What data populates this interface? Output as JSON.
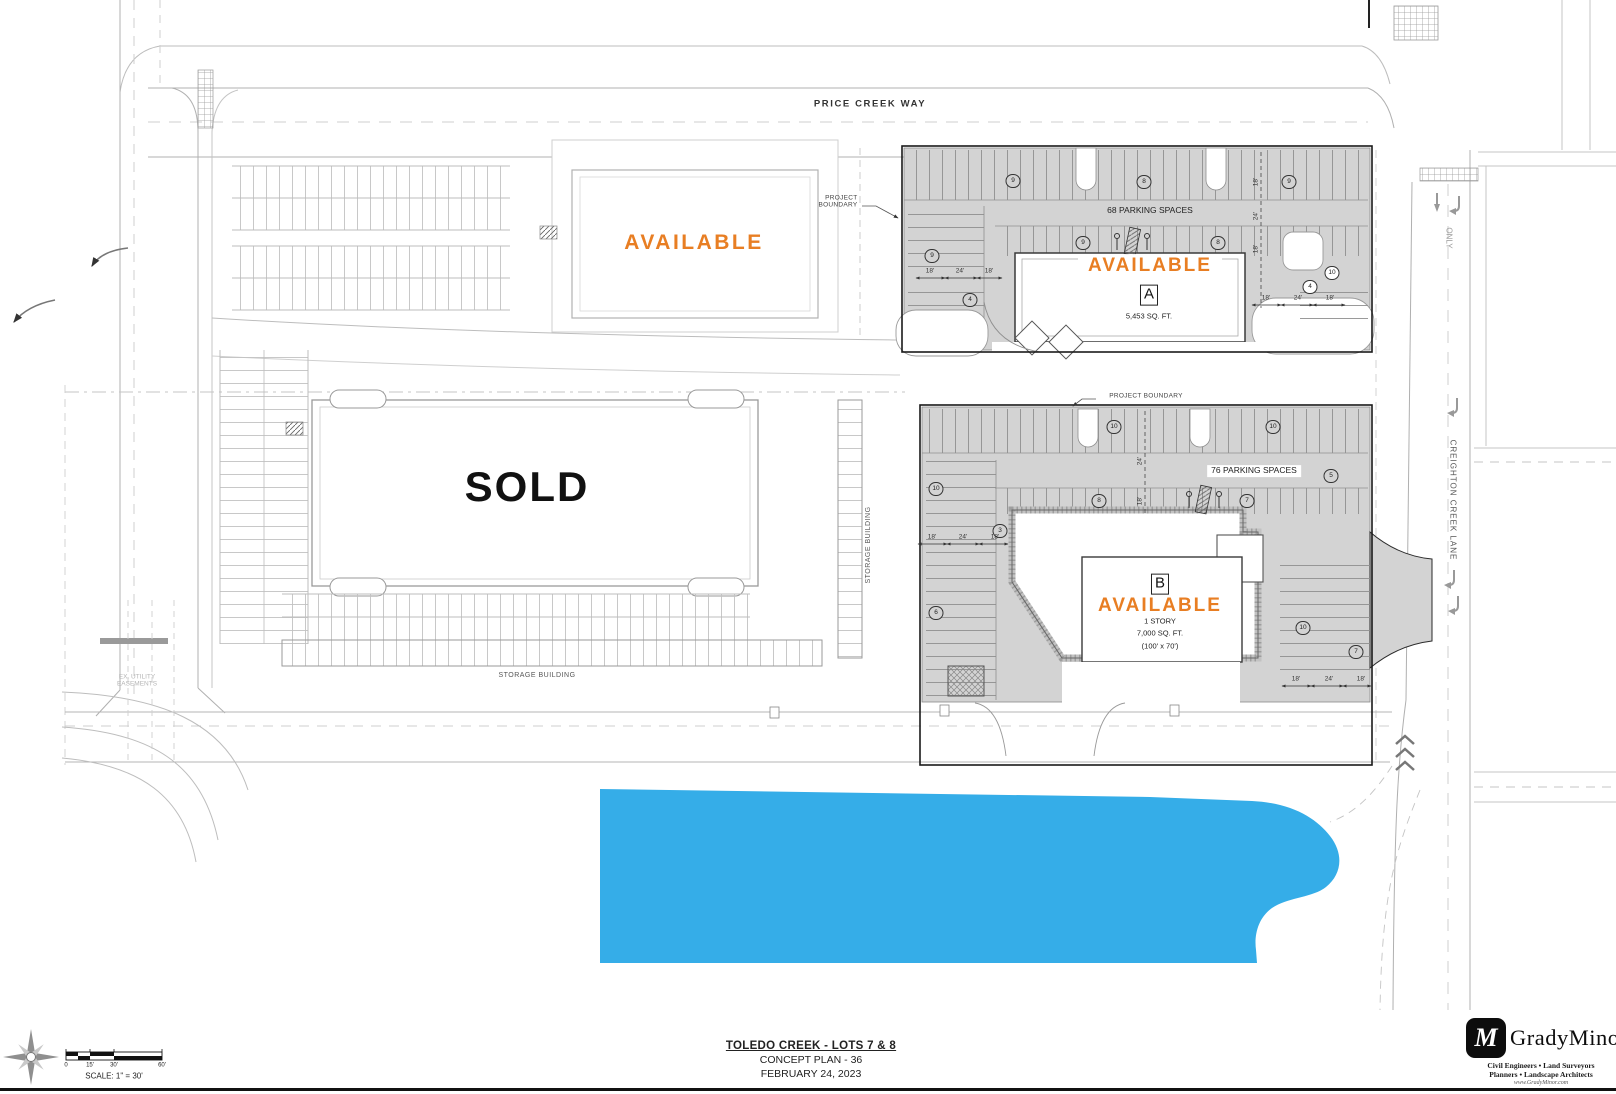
{
  "colors": {
    "available_orange": "#E87E23",
    "lake_blue": "#35ADE8",
    "parking_gray": "#D3D3D3",
    "linework_gray": "#9A9A9A",
    "boundary_black": "#1A1A1A"
  },
  "streets": {
    "price_creek_way": "PRICE CREEK WAY",
    "creighton_creek_lane": "CREIGHTON CREEK LANE",
    "only_marking": "ONLY"
  },
  "parcels": {
    "nw_lot": {
      "status": "AVAILABLE"
    },
    "sold_lot": {
      "status": "SOLD"
    },
    "lot_a": {
      "status": "AVAILABLE",
      "building_letter": "A",
      "area": "5,453 SQ. FT.",
      "parking_label": "68 PARKING SPACES",
      "counts": [
        "9",
        "8",
        "9",
        "9",
        "8",
        "10",
        "9",
        "4",
        "4"
      ],
      "dims_left": [
        "18'",
        "24'",
        "18'"
      ],
      "dims_right": [
        "18'",
        "24'",
        "18'"
      ],
      "dims_vertical": [
        "18'",
        "24'",
        "18'"
      ]
    },
    "lot_b": {
      "status": "AVAILABLE",
      "building_letter": "B",
      "story": "1 STORY",
      "area": "7,000 SQ. FT.",
      "footprint": "(100' x 70')",
      "parking_label": "76 PARKING SPACES",
      "counts": [
        "10",
        "10",
        "5",
        "8",
        "7",
        "10",
        "3",
        "6",
        "10",
        "7"
      ],
      "dims_left": [
        "18'",
        "24'",
        "18'"
      ],
      "dims_bottom": [
        "18'",
        "24'",
        "18'"
      ],
      "dims_vertical": [
        "24'",
        "18'"
      ]
    }
  },
  "annotations": {
    "project_boundary_line1": "PROJECT",
    "project_boundary_line2": "BOUNDARY",
    "project_boundary_full": "PROJECT  BOUNDARY",
    "storage_building_vertical": "STORAGE BUILDING",
    "storage_building_horizontal": "STORAGE BUILDING",
    "ex_utility_line1": "EX. UTILITY",
    "ex_utility_line2": "EASEMENTS"
  },
  "title_block": {
    "title": "TOLEDO CREEK - LOTS 7 & 8",
    "subtitle": "CONCEPT PLAN - 36",
    "date": "FEBRUARY 24, 2023"
  },
  "scale_bar": {
    "ticks": [
      "0",
      "15'",
      "30'",
      "60'"
    ],
    "label": "SCALE: 1\" = 30'"
  },
  "logo": {
    "monogram": "M",
    "name": "GradyMinor",
    "line1": "Civil Engineers  •  Land Surveyors",
    "line2": "Planners  •  Landscape Architects",
    "website": "www.GradyMinor.com"
  }
}
